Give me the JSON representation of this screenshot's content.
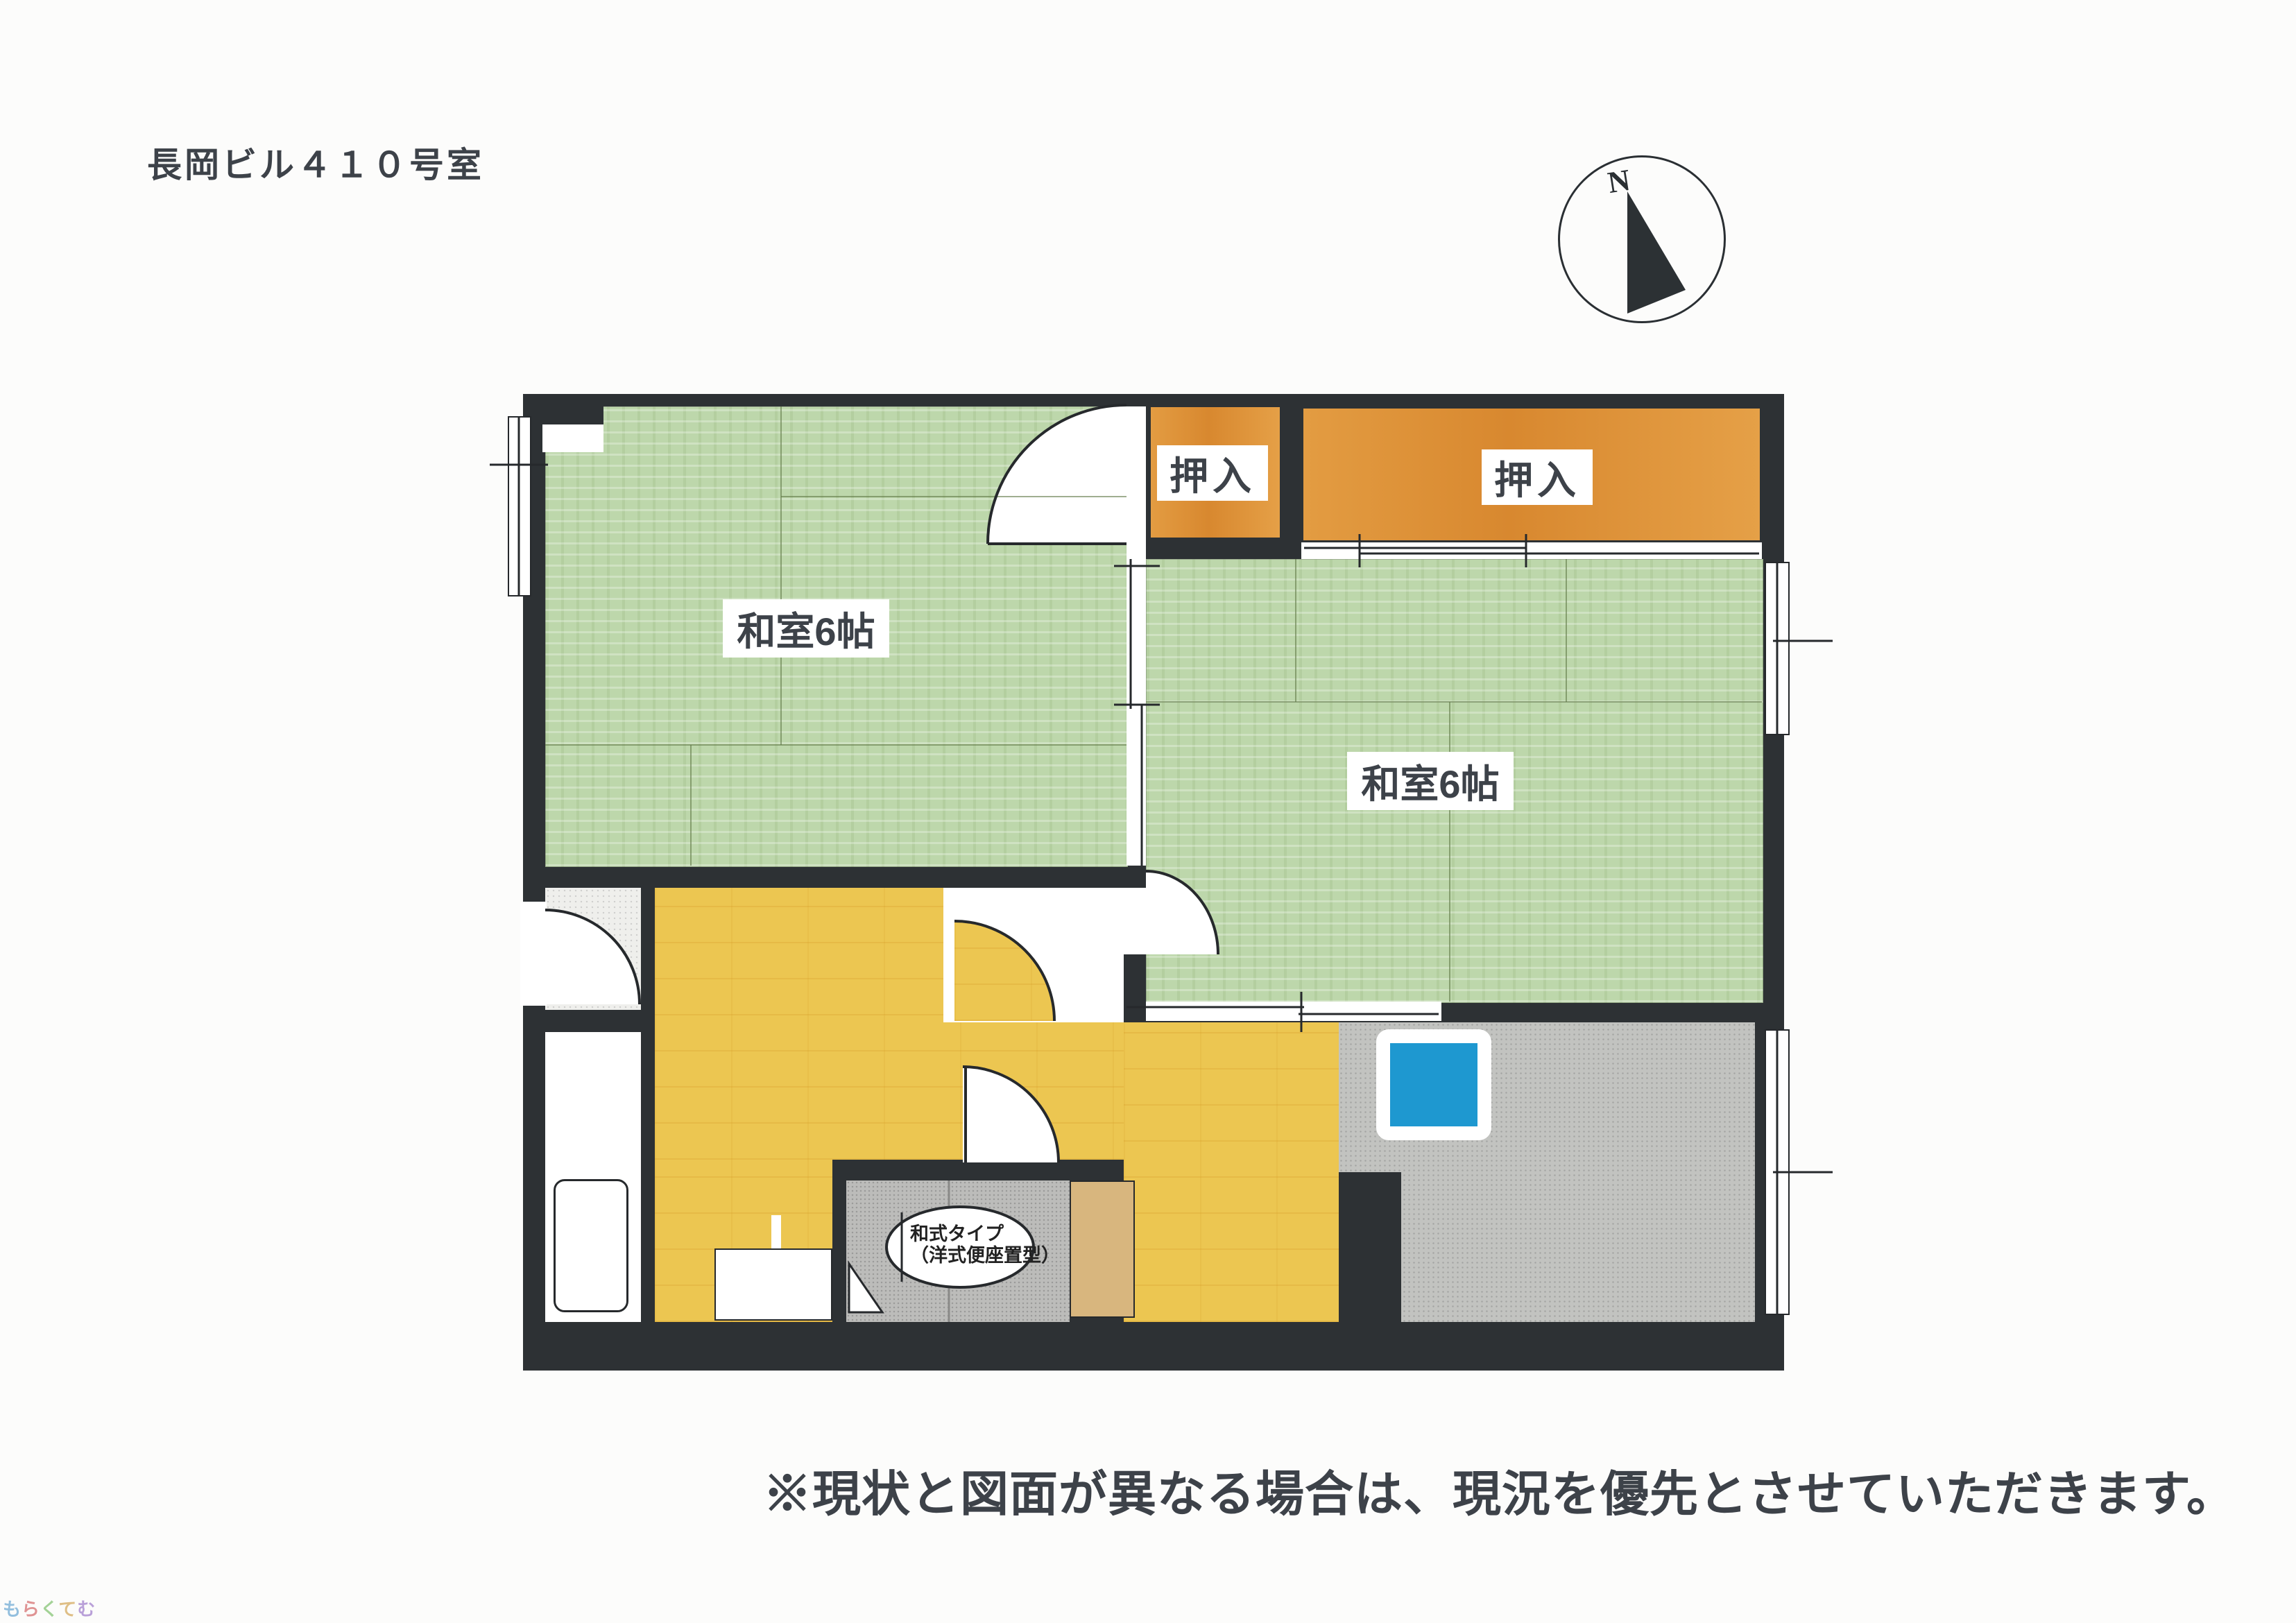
{
  "title": "長岡ビル４１０号室",
  "disclaimer": "※現状と図面が異なる場合は、現況を優先とさせていただきます。",
  "compass": {
    "north": "N"
  },
  "plan": {
    "room1_label": "和室6帖",
    "room2_label": "和室6帖",
    "closet1_label": "押入",
    "closet2_label": "押入",
    "toilet_note_line1": "和式タイプ",
    "toilet_note_line2": "（洋式便座置型）"
  },
  "watermark": [
    {
      "ch": "も",
      "color": "#7ab0d8"
    },
    {
      "ch": "ら",
      "color": "#d87a7a"
    },
    {
      "ch": "く",
      "color": "#8ec87e"
    },
    {
      "ch": "て",
      "color": "#d8b06a"
    },
    {
      "ch": "む",
      "color": "#a98ad0"
    }
  ],
  "colors": {
    "paper": "#fcfcfb",
    "wall": "#2d3134",
    "tatami": "#bdd7ab",
    "closet_orange": "#df953c",
    "floor": "#ecc651",
    "counter": "#c2c3c0",
    "toilet": "#bcbcba",
    "sink": "#1e98d0",
    "tan": "#d8b67e",
    "ink": "#3d4249"
  }
}
